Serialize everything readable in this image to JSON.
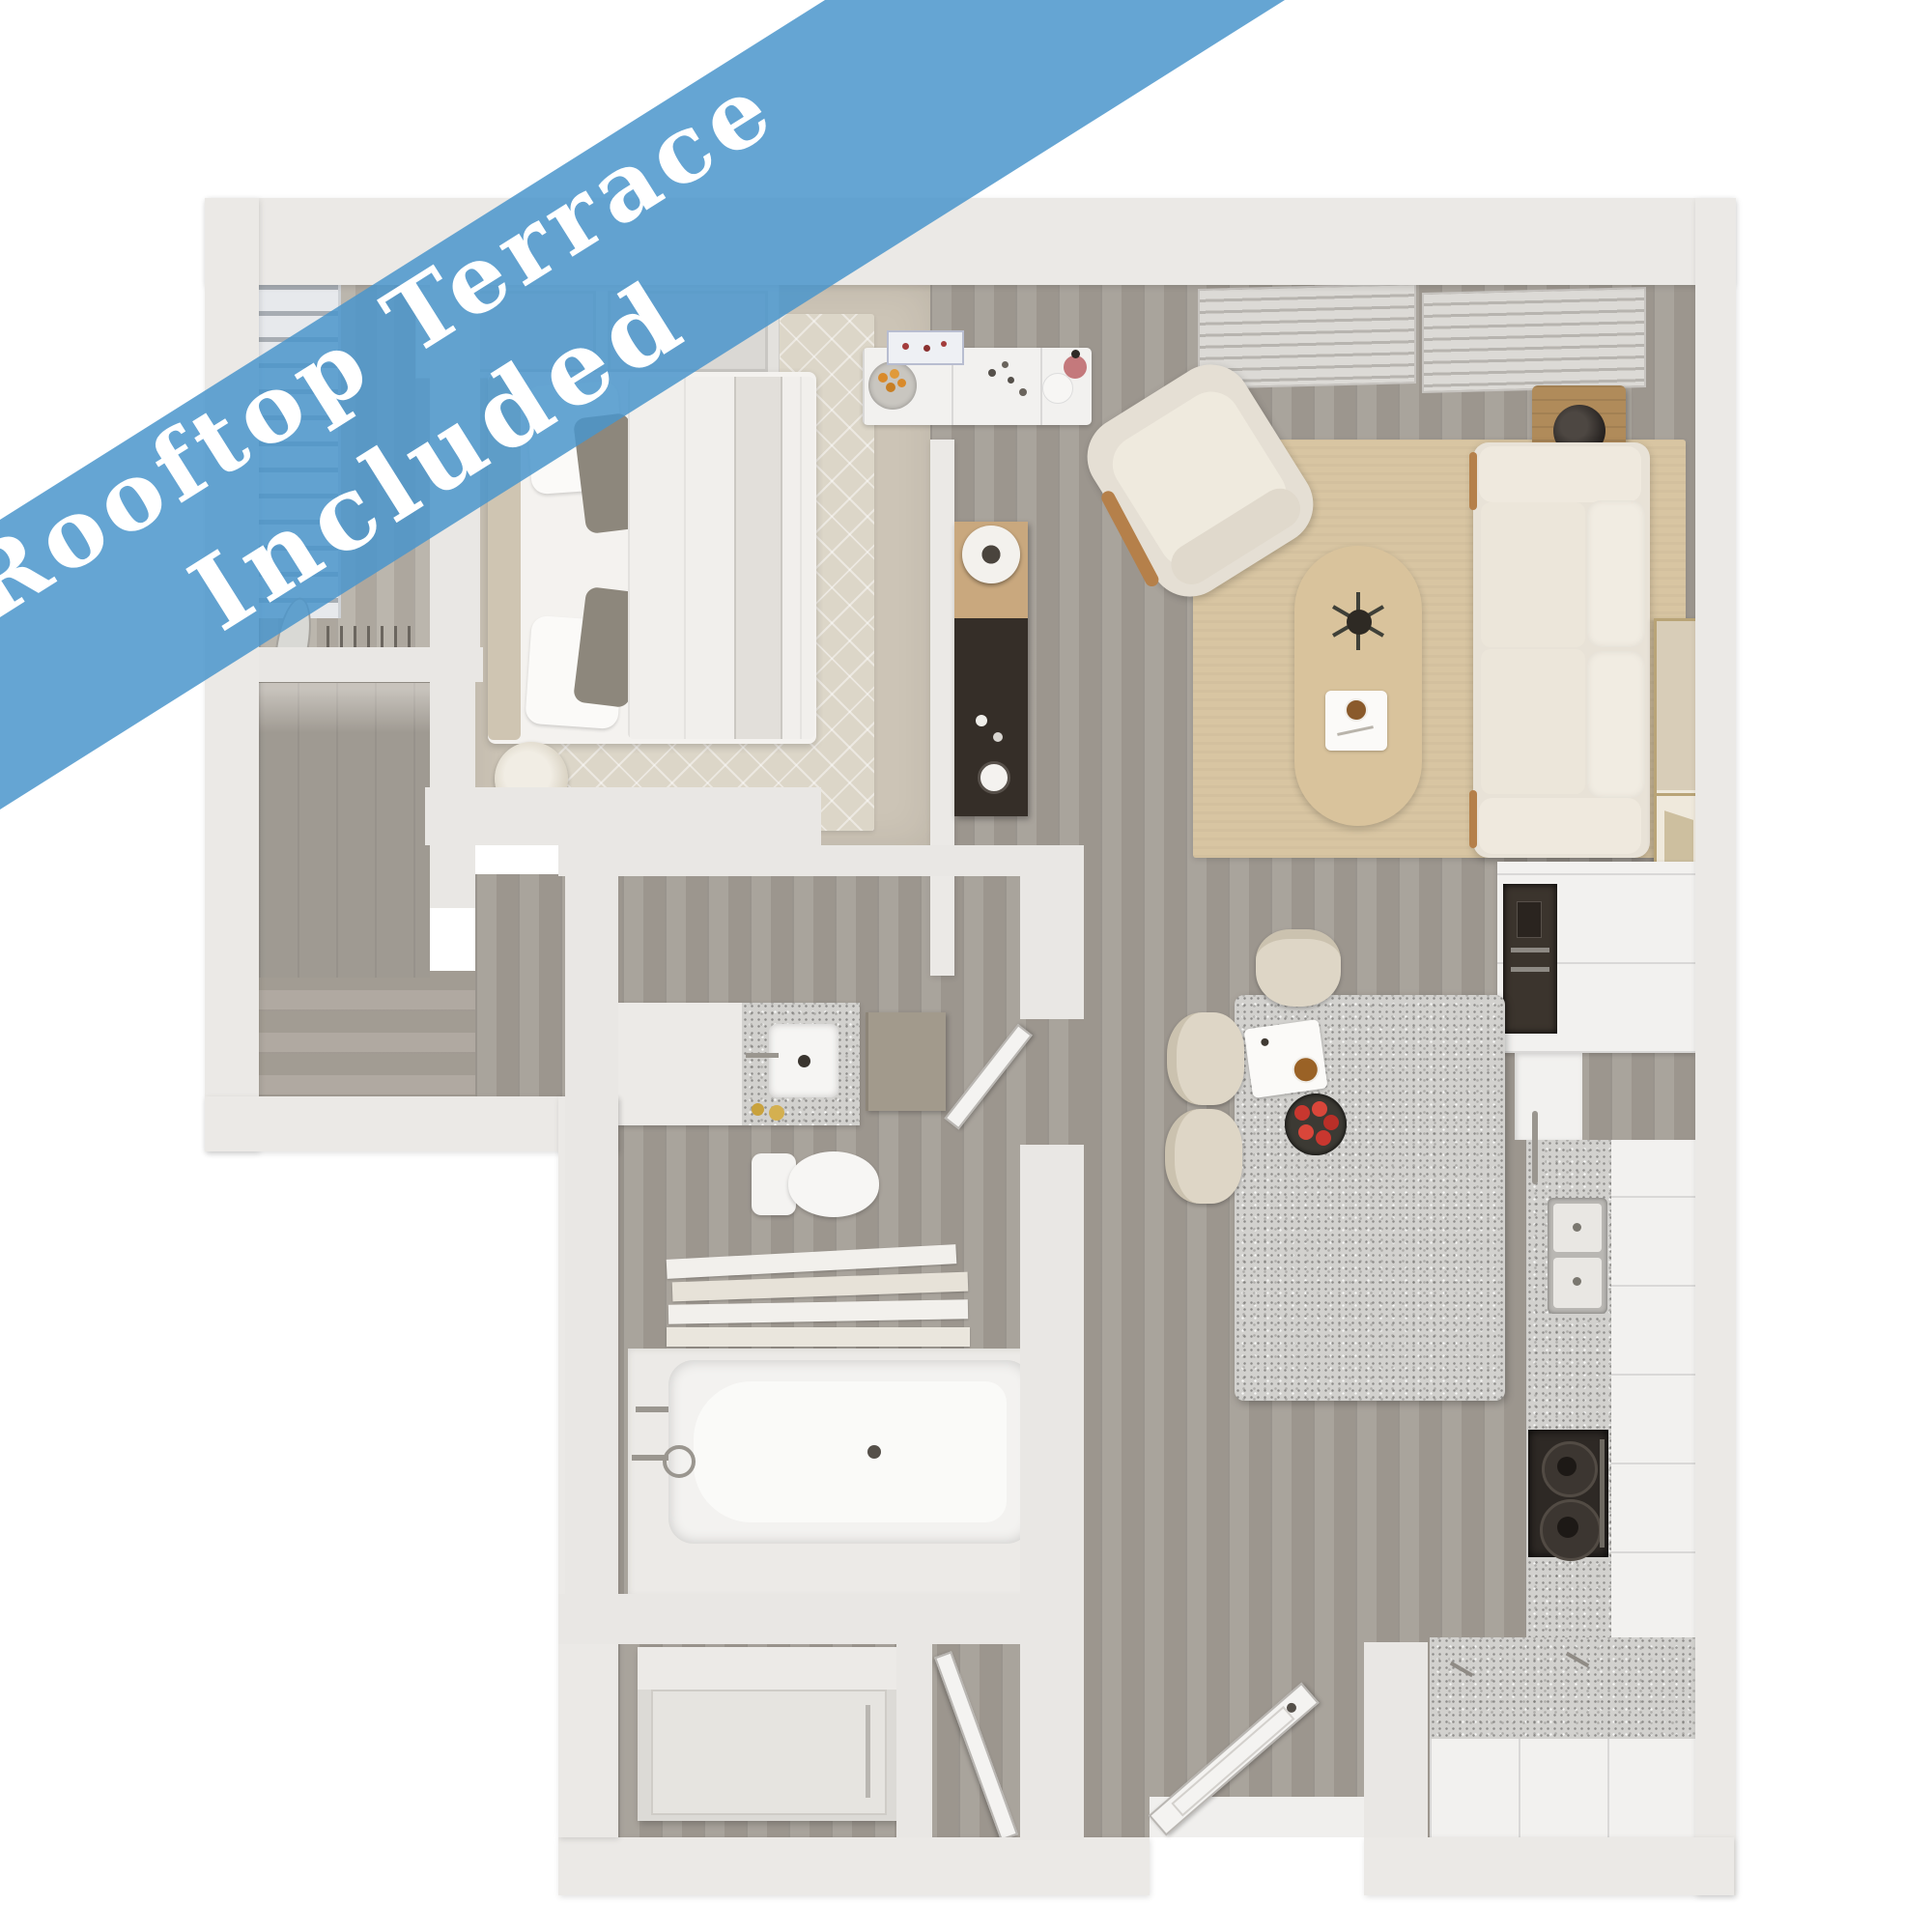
{
  "banner": {
    "line1": "Rooftop Terrace",
    "line2": "Included",
    "color": "#4E96C8",
    "text_color": "#FFFFFF"
  },
  "floorplan": {
    "type": "apartment-3d-top-view",
    "rooms": [
      "bedroom",
      "closet",
      "stairs",
      "living-room",
      "kitchen",
      "dining-island",
      "bathroom",
      "laundry-closet",
      "entry"
    ],
    "furniture": [
      "bed",
      "bedside-lamp",
      "hanger-rod",
      "shelf-unit",
      "media-console",
      "sideboard",
      "armchair",
      "sofa",
      "side-table",
      "coffee-table",
      "artwork",
      "kitchen-island",
      "stools",
      "oven",
      "sink",
      "stove",
      "vanity",
      "toilet",
      "bathtub",
      "towels",
      "washer",
      "entry-door"
    ],
    "colors": {
      "wood_floor": "#A49E96",
      "carpet": "#CCC4B6",
      "granite": "#D2D1CE",
      "area_rug": "#D8C5A2",
      "walls": "#EBE9E6",
      "wood_accent": "#B08B5A",
      "dark_appliance": "#362F29"
    }
  }
}
